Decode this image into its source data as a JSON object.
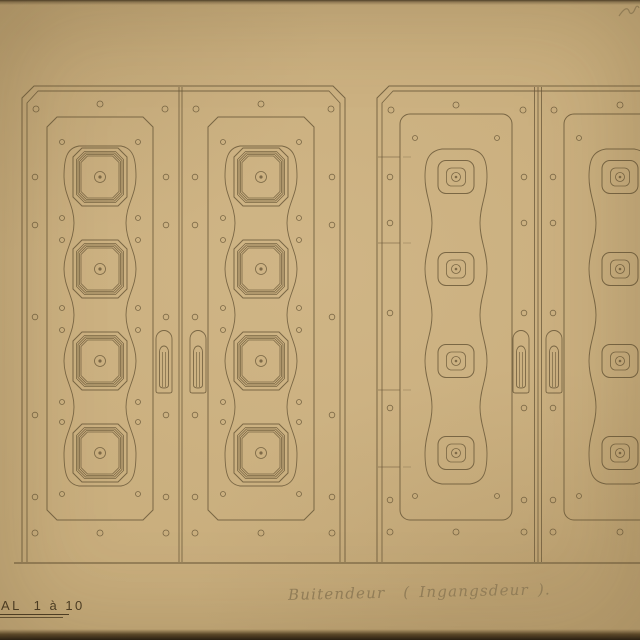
{
  "labels": {
    "scale": "AL  1 à 10",
    "note": "Buitendeur  ( Ingangsdeur )."
  },
  "colors": {
    "paper": "#c8ad7c",
    "paper_light": "#d6bc8e",
    "paper_dark": "#b1976a",
    "ink": "#6b5939",
    "ink_dark": "#4c3d24",
    "pencil": "#95815b",
    "photo_edge": "#241b10"
  },
  "drawing": {
    "ground_y": 563,
    "top_y": 86,
    "door_bottom": 562,
    "boss_rows": [
      177,
      269,
      361,
      453
    ],
    "pinch_rows": [
      223,
      315,
      407
    ],
    "handle_top": 331,
    "handle_bottom": 393,
    "scribble": {
      "x": 619,
      "y": 8
    },
    "styles": {
      "ornate": {
        "panel_top": 117,
        "panel_bottom": 520,
        "panel_chamfer": 10,
        "bulge": 36,
        "pinch": 26,
        "top_hw": 21,
        "wave_top": 146,
        "wave_bottom": 486,
        "boss": {
          "kind": "octagon-rings",
          "rings": [
            [
              27,
              29,
              9
            ],
            [
              23.5,
              25.5,
              8
            ],
            [
              22,
              24,
              7.5
            ],
            [
              20.5,
              22.5,
              7
            ],
            [
              19,
              21,
              6.5
            ]
          ],
          "circle_r": 5.5,
          "dot_r": 1.6
        },
        "rivets": {
          "top_y": 104,
          "corner_y": 109,
          "bottom_y": 533,
          "stile_rows": [
            177,
            225,
            317,
            415,
            497
          ],
          "panel_rows": [
            142,
            218,
            240,
            308,
            330,
            402,
            422,
            494
          ]
        }
      },
      "simple": {
        "panel_top": 114,
        "panel_bottom": 520,
        "panel_radius": 10,
        "bulge": 31,
        "pinch": 24,
        "top_hw": 14,
        "wave_top": 149,
        "wave_bottom": 484,
        "boss": {
          "kind": "rounded-square",
          "outer": [
            18,
            16.5,
            8
          ],
          "inner": [
            9.5,
            9,
            5
          ],
          "circle_r": 4.5,
          "dot_r": 1.3
        },
        "rivets": {
          "top_y": 105,
          "corner_y": 110,
          "bottom_y": 532,
          "stile_rows": [
            177,
            223,
            313,
            408,
            500
          ],
          "panel_rows": [
            138,
            496
          ]
        }
      }
    },
    "pairs": [
      {
        "name": "ornate-door-pair",
        "style": "ornate",
        "x1": 22,
        "x2": 345,
        "meet": [
          179,
          182
        ],
        "leaves": [
          {
            "ol": 22,
            "or": 179,
            "pl": 47,
            "pr": 153,
            "handle_x": 156,
            "hinges": []
          },
          {
            "ol": 182,
            "or": 345,
            "pl": 208,
            "pr": 314,
            "handle_x": 190,
            "hinges": []
          }
        ]
      },
      {
        "name": "simple-door-pair",
        "style": "simple",
        "x1": 377,
        "x2": 702,
        "meet": [
          534.5,
          538,
          541.5
        ],
        "leaves": [
          {
            "ol": 377,
            "or": 537,
            "pl": 400,
            "pr": 512,
            "handle_x": 513,
            "hinges": [
              157,
              243,
              390,
              467
            ]
          },
          {
            "ol": 540,
            "or": 702,
            "pl": 564,
            "pr": 676,
            "handle_x": 546,
            "hinges": []
          }
        ]
      }
    ]
  }
}
